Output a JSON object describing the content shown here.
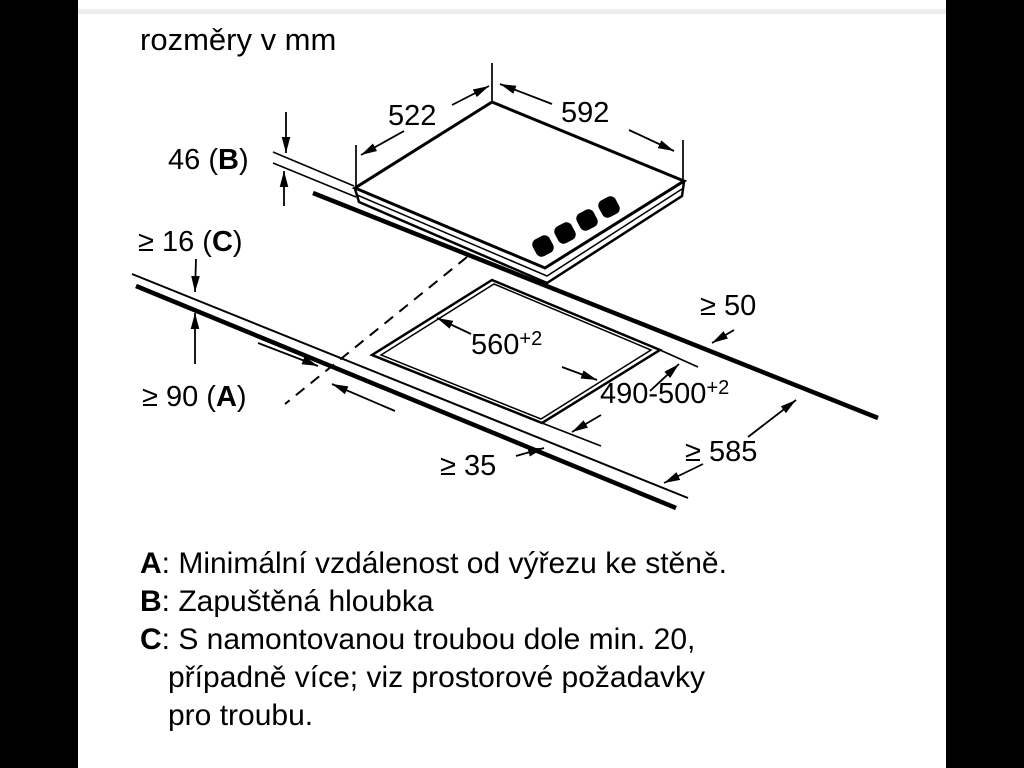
{
  "colors": {
    "page_bg": "#000000",
    "canvas_bg": "#ffffff",
    "line": "#000000",
    "top_strip": "#ededed"
  },
  "title": "rozměry v mm",
  "dims": {
    "depth_top": "522",
    "width_top": "592",
    "b_prefix": "46 (",
    "b_letter": "B",
    "b_suffix": ")",
    "c_prefix": "≥ 16 (",
    "c_letter": "C",
    "c_suffix": ")",
    "a_prefix": "≥ 90 (",
    "a_letter": "A",
    "a_suffix": ")",
    "side_right": "≥ 50",
    "cutout_width": "560",
    "cutout_width_tol": "+2",
    "cutout_depth": "490-500",
    "cutout_depth_tol": "+2",
    "counter_depth": "≥ 585",
    "front_min": "≥ 35"
  },
  "legend": {
    "rows": [
      {
        "letter": "A",
        "text": ": Minimální vzdálenost od výřezu ke stěně."
      },
      {
        "letter": "B",
        "text": ": Zapuštěná hloubka"
      },
      {
        "letter": "C",
        "text": ": S namontovanou troubou dole min. 20,"
      },
      {
        "letter": "",
        "text": "případně více; viz prostorové požadavky"
      },
      {
        "letter": "",
        "text": "pro troubu."
      }
    ]
  }
}
